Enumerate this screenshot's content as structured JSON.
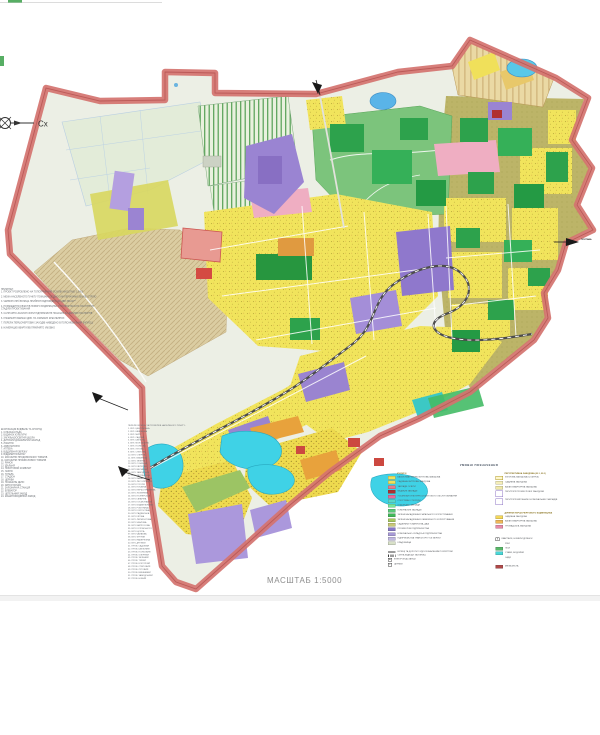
{
  "page": {
    "background": "#ffffff"
  },
  "map": {
    "compass_label": "Сх",
    "scale_label": "МАСШТАБ 1:5000",
    "exit_label_right": "ПОЛТАВА",
    "colors": {
      "boundary": "#d4736f",
      "residential_yellow": "#f1e45c",
      "industrial_purple": "#9a84d2",
      "green_public": "#2da24c",
      "green_limited": "#bcb468",
      "water_cyan": "#3fd2e6",
      "fields_tan": "#dbcda2",
      "pink_public": "#efaec2",
      "orange_firstpriority": "#e8a23c"
    }
  },
  "legend": {
    "title": "УМОВНІ ПОЗНАЧЕННЯ",
    "left": [
      {
        "h": "ІСНУЮЧІ"
      },
      {
        "c": "#f0e05a",
        "label": "БАГАТОКВАРТИРНА ЖИТЛОВА ЗАБУДОВА"
      },
      {
        "c": "#f0e05a",
        "label": "САДИБНА ЖИТЛОВА ЗАБУДОВА"
      },
      {
        "c": "#e87a8a",
        "label": "ЗАКЛАДИ ОСВІТИ"
      },
      {
        "c": "#b03030",
        "label": "МЕДИЧНІ ЗАКЛАДИ"
      },
      {
        "c": "#e86a9a",
        "label": "УСТАНОВИ КУЛЬТУРНО-ПОБУТОВОГО ОБСЛУГОВУВАННЯ"
      },
      {
        "c": "#58d8c8",
        "label": "СПОРТИВНІ СПОРУДИ"
      },
      {
        "c": "#78e89a",
        "label": "ОЗДОРОВЧІ ЗАКЛАДИ"
      },
      {
        "c": "#58c878",
        "label": "КОМУНАЛЬНІ ЗАКЛАДИ"
      },
      {
        "c": "#40b858",
        "label": "ЗЕЛЕНІ НАСАДЖЕННЯ ЗАГАЛЬНОГО КОРИСТУВАННЯ"
      },
      {
        "c": "#a8c860",
        "label": "ЗЕЛЕНІ НАСАДЖЕННЯ ОБМЕЖЕНОГО КОРИСТУВАННЯ"
      },
      {
        "c": "#c8c878",
        "label": "САДІВНИЧІ ТОВАРИСТВА, ДАЧІ"
      },
      {
        "c": "#8878c8",
        "label": "ПРОМИСЛОВІ ПІДПРИЄМСТВА"
      },
      {
        "c": "#a89ad8",
        "label": "КОМУНАЛЬНО-СКЛАДСЬКІ ПІДПРИЄМСТВА"
      },
      {
        "c": "#c0b8e0",
        "label": "ПІДПРИЄМСТВА ТРАНСПОРТУ ТА ЗВ'ЯЗКУ"
      },
      {
        "c": "#d8e0c8",
        "label": "КЛАДОВИЩА"
      },
      {
        "sp": true
      },
      {
        "t": "line",
        "label": "ВУЛИЦІ ТА ДОРОГИ З УДОСКОНАЛЕНИМ ПОКРИТТЯМ"
      },
      {
        "t": "hatch",
        "label": "СМУГА ВІДВОДУ ЗАЛІЗНИЦІ"
      },
      {
        "t": "box",
        "sym": "Е",
        "label": "ЕЛЕКТРОПІДСТАНЦІЇ"
      },
      {
        "t": "box",
        "sym": "▪",
        "label": "ЦЕРКВИ"
      }
    ],
    "right": [
      {
        "h": "ПЕРСПЕКТИВНА ЗАБУДОВА (Ж-1, Ж-2)"
      },
      {
        "t": "outline",
        "c": "#fdf6cc",
        "b": "#b09a28",
        "label": "ЖИТЛОВА ЗАБУДОВА (І-ІІ ЧЕРГА)"
      },
      {
        "c": "#f5eeb8",
        "label": "САДИБНА ЗАБУДОВА"
      },
      {
        "c": "#f0e8a8",
        "label": "БАГАТОКВАРТИРНА ЗАБУДОВА"
      },
      {
        "t": "outline",
        "tall": true,
        "c": "#ffffff",
        "b": "#8f76c6",
        "label": "ТЕРИТОРІЇ ПРОМИСЛОВОЇ ЗАБУДОВИ"
      },
      {
        "t": "outline",
        "tall": true,
        "c": "#ffffff",
        "b": "#8f76c6",
        "label": "ТЕРИТОРІЇ ВИРОБНИЧО-КОМУНАЛЬНИХ ЗАКЛАДІВ"
      },
      {
        "sp": true
      },
      {
        "h": "ДІЛЯНКИ ПЕРШОЧЕРГОВОГО БУДІВНИЦТВА"
      },
      {
        "c": "#f5d858",
        "label": "САДИБНА ЗАБУДОВА"
      },
      {
        "c": "#f0b858",
        "label": "БАГАТОКВАРТИРНА ЗАБУДОВА"
      },
      {
        "c": "#e88aa8",
        "label": "ГРОМАДСЬКА ЗАБУДОВА"
      },
      {
        "sp": true
      },
      {
        "sp": true
      },
      {
        "t": "boxx",
        "sym": "х",
        "label": "КВАРТАЛИ, НОМЕРИ ДІЛЯНОК"
      },
      {
        "t": "none",
        "label": "РІКИ"
      },
      {
        "c": "#58b868",
        "label": "ЛІСИ"
      },
      {
        "c": "#48d8d8",
        "label": "СТАВИ, ВОДОЙМИ"
      },
      {
        "t": "none",
        "label": "САДИ"
      },
      {
        "sp": true
      },
      {
        "c": "#b04848",
        "label": "МЕЖА МІСТА"
      }
    ]
  },
  "notes": {
    "col1": {
      "lines": [
        "ПРИМІТКИ:",
        "1. ПРОЕКТ РОЗРОБЛЕНО НА ТОПОГРАФІЧНІЙ ОСНОВІ МАСШТАБУ 1:5000",
        "",
        "2. МЕЖА НАСЕЛЕНОГО ПУНКТУ ПОКАЗАНА ЗГІДНО З МАТЕРІАЛАМИ ЗЕМЛЕУСТРОЮ",
        "",
        "3. ЧЕРВОНІ ЛІНІЇ ВУЛИЦЬ ПРИЙНЯТІ ВІДПОВІДНО ДО ДБН 360-92**",
        "",
        "4. РОЗМІЩЕННЯ ОБ'ЄКТІВ НОВОГО БУДІВНИЦТВА УТОЧНЮЄТЬСЯ НА НАСТУПНИХ СТАДІЯХ ПРОЕКТУВАННЯ",
        "",
        "5. САНІТАРНО-ЗАХИСНІ ЗОНИ ПІДПРИЄМСТВ ПОКАЗАНІ ЗА ДАНИМИ ПАСПОРТІВ",
        "",
        "6. ІНЖЕНЕРНІ МЕРЕЖІ ДИВ. НА ОКРЕМИХ КРЕСЛЕННЯХ",
        "",
        "7. ПЕРЕЛІК ПЕРШОЧЕРГОВИХ ЗАХОДІВ НАВЕДЕНО В ПОЯСНЮВАЛЬНІЙ ЗАПИСЦІ",
        "",
        "8. НУМЕРАЦІЮ КВАРТАЛІВ ПРИЙНЯТО УМОВНО"
      ]
    },
    "col2": {
      "lines": [
        "ЕКСПЛІКАЦІЯ БУДІВЕЛЬ ТА СПОРУД:",
        "1. СІЛЬСЬКА РАДА",
        "2. БУДИНОК КУЛЬТУРИ",
        "3. ЗАГАЛЬНООСВІТНЯ ШКОЛА",
        "4. ДИТЯЧИЙ ДОШКІЛЬНИЙ ЗАКЛАД",
        "5. ЛІКАРНЯ",
        "6. АМБУЛАТОРІЯ",
        "7. АПТЕКА",
        "8. ВІДДІЛЕННЯ ЗВ'ЯЗКУ",
        "9. ВІДДІЛЕННЯ БАНКУ",
        "10. МАГАЗИНИ ПРОДОВОЛЬЧИХ ТОВАРІВ",
        "11. МАГАЗИНИ ПРОМИСЛОВИХ ТОВАРІВ",
        "12. РИНОК",
        "13. ЇДАЛЬНЯ",
        "14. ПОБУТОВИЙ КОМБІНАТ",
        "15. ЛАЗНЯ",
        "16. ГОТЕЛЬ",
        "17. СТАДІОН",
        "18. ЦЕРКВА",
        "19. ПОЖЕЖНЕ ДЕПО",
        "20. АВТОСТАНЦІЯ",
        "21. ЗАЛІЗНИЧНА СТАНЦІЯ",
        "22. ЕЛЕВАТОР",
        "23. ЦЕГЕЛЬНИЙ ЗАВОД",
        "24. МАШИНОБУДІВНИЙ ЗАВОД"
      ]
    },
    "col3": {
      "lines": [
        "ПЕРЕЛІК ВУЛИЦЬ ТА ПРОВУЛКІВ НАСЕЛЕНОГО ПУНКТУ:",
        "1. ВУЛ. ЦЕНТРАЛЬНА",
        "2. ВУЛ. ШЕВЧЕНКА",
        "3. ВУЛ. МИРУ",
        "4. ВУЛ. САДОВА",
        "5. ВУЛ. ШКІЛЬНА",
        "6. ВУЛ. МОЛОДІЖНА",
        "7. ВУЛ. ПОЛЬОВА",
        "8. ВУЛ. ЛУГОВА",
        "9. ВУЛ. СТЕПОВА",
        "10. ВУЛ. ОЗЕРНА",
        "11. ВУЛ. ВИШНЕВА",
        "12. ВУЛ. ЗЕЛЕНА",
        "13. ВУЛ. СОНЯЧНА",
        "14. ВУЛ. КВІТКОВА",
        "15. ВУЛ. ВЕСНЯНА",
        "16. ВУЛ. ЗАВОДСЬКА",
        "17. ВУЛ. ЗАЛІЗНИЧНА",
        "18. ВУЛ. ІВАНА ФРАНКА",
        "19. ВУЛ. ЛЕСІ УКРАЇНКИ",
        "20. ВУЛ. ГОГОЛЯ",
        "21. ВУЛ. ПУШКІНА",
        "22. ВУЛ. ПЕРШОТРАВНЕВА",
        "23. ВУЛ. ЖОВТНЕВА",
        "24. ВУЛ. ПІОНЕРСЬКА",
        "25. ВУЛ. ГАГАРІНА",
        "26. ВУЛ. КОСМОНАВТІВ",
        "27. ВУЛ. БУДІВЕЛЬНИКІВ",
        "28. ВУЛ. РОБІТНИЧА",
        "29. ВУЛ. КОЛГОСПНА",
        "30. ВУЛ. РАДЯНСЬКА",
        "31. ВУЛ. КІРОВА",
        "32. ВУЛ. ЛЕРМОНТОВА",
        "33. ВУЛ. ЧКАЛОВА",
        "34. ВУЛ. МАТРОСОВА",
        "35. ВУЛ. КОТОВСЬКОГО",
        "36. ВУЛ. ЩОРСА",
        "37. ВУЛ. ЧАПАЄВА",
        "38. ВУЛ. ФРУНЗЕ",
        "39. ВУЛ. НАБЕРЕЖНА",
        "40. ВУЛ. ДРУЖБИ",
        "41. ПРОВ. САДОВИЙ",
        "42. ПРОВ. ШКІЛЬНИЙ",
        "43. ПРОВ. ПОЛЬОВИЙ",
        "44. ПРОВ. ОЗЕРНИЙ",
        "45. ПРОВ. ЗЕЛЕНИЙ",
        "46. ПРОВ. ТИХИЙ",
        "47. ПРОВ. КОРОТКИЙ",
        "48. ПРОВ. СТЕПОВИЙ",
        "49. ПРОВ. ЛУГОВИЙ",
        "50. ПРОВ. ВИШНЕВИЙ",
        "51. ПРОВ. ЗАВОДСЬКИЙ",
        "52. ПРОВ. НОВИЙ"
      ]
    }
  }
}
